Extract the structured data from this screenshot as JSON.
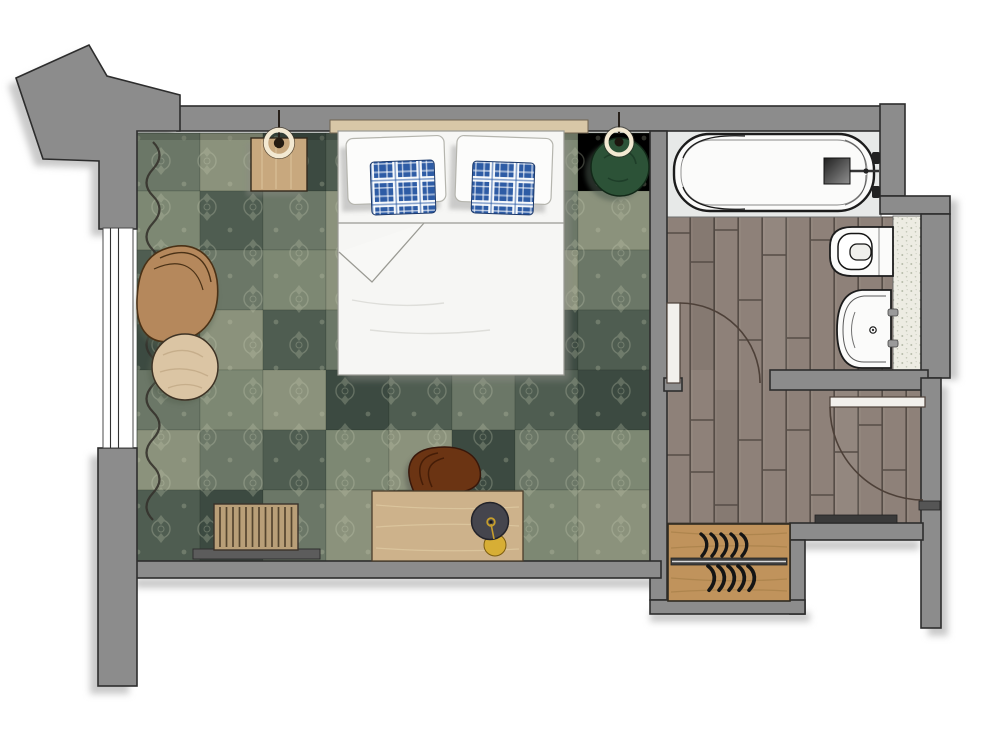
{
  "meta": {
    "title": "Hotel guest room floor plan, top-down architectural rendering",
    "type": "floor-plan",
    "canvas": "1000x732",
    "visible_text": "none"
  },
  "rooms": [
    {
      "id": "bedroom",
      "floor": "green patchwork carpet",
      "furniture": [
        "double-bed",
        "white-pillows-x2",
        "blue-plaid-pillows-x2",
        "headboard",
        "nightstand",
        "pendant-lamp-left",
        "green-pouf",
        "pendant-lamp-right",
        "armchair",
        "round-side-table",
        "luggage-bench",
        "desk",
        "desk-chair",
        "brass-stool",
        "curtain",
        "window"
      ]
    },
    {
      "id": "bathroom",
      "floor": "grey-brown wood planks",
      "fixtures": [
        "bathtub",
        "shower-mixer",
        "toilet",
        "washbasin",
        "tiled-vanity-strip",
        "bathroom-door"
      ]
    },
    {
      "id": "entry-hall",
      "floor": "grey-brown wood planks",
      "fixtures": [
        "entry-door",
        "door-threshold",
        "wardrobe-shelf-with-hangers",
        "vestibule-niche"
      ]
    }
  ],
  "colors": {
    "wall": "#8c8c8c",
    "wall_line": "#2d2d2d",
    "wall_shadow": "#c9c9c9",
    "carpet_0": "#8b927c",
    "carpet_1": "#4f5d51",
    "carpet_2": "#6b7767",
    "carpet_3": "#3c4a41",
    "carpet_4": "#7d8873",
    "wood_floor": "#8e8179",
    "wood_gap": "#564d47",
    "wood_light": "#a2958c",
    "tub_floor": "#e7e9e8",
    "tile_base": "#edece3",
    "tile_dot": "#b7bcab",
    "fixture_white": "#fbfbfa",
    "fixture_line": "#1c1c1c",
    "bed_white": "#f6f6f4",
    "pillow_white": "#fcfcfb",
    "bed_line": "#9a9a93",
    "headboard": "#d8c7a7",
    "plaid_blue": "#2e5ca5",
    "door_leaf": "#f2f0ec",
    "door_line": "#4d4038",
    "threshold": "#3a3a3a",
    "curtain": "#34312b",
    "cord": "#27201a",
    "lamp_ring": "#f3e9d2",
    "pouf_green": "#2c5237",
    "pouf_dark": "#1b3a26",
    "leather": "#b5885c",
    "table_wood": "#dbc5a4",
    "furn_wood": "#c8a87e",
    "desk_wood": "#cdb28b",
    "bench_wood": "#b99f78",
    "wardrobe_wood": "#c0935c",
    "chair_brown": "#6b3413",
    "stool_dark": "#45454d",
    "brass": "#c79e2c",
    "gold": "#d7ae35"
  }
}
